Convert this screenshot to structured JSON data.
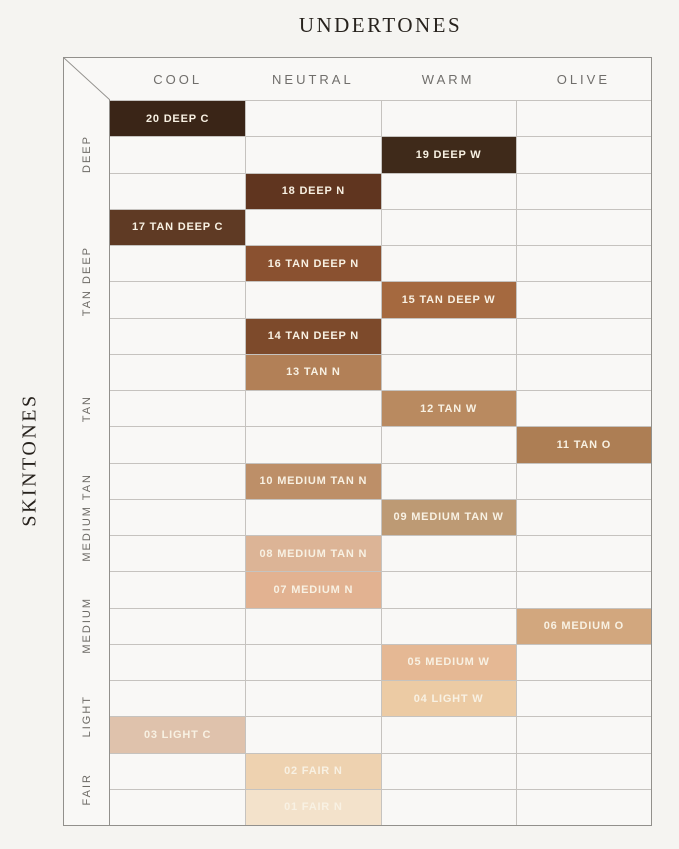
{
  "page": {
    "top_title": "UNDERTONES",
    "left_title": "SKINTONES"
  },
  "palette": {
    "page_bg": "#f5f4f1",
    "board_bg": "#f9f8f6",
    "outer_border": "#92908c",
    "grid_line": "#c6c3bf",
    "title_text": "#27221d",
    "header_text": "#706e6b",
    "group_text": "#6d6a65",
    "swatch_text": "#f8f1e3"
  },
  "chart_data": {
    "type": "table",
    "title": "UNDERTONES",
    "row_axis_label": "SKINTONES",
    "columns": [
      "COOL",
      "NEUTRAL",
      "WARM",
      "OLIVE"
    ],
    "row_groups": [
      {
        "label": "DEEP",
        "row_span": 3
      },
      {
        "label": "TAN DEEP",
        "row_span": 4
      },
      {
        "label": "TAN",
        "row_span": 3
      },
      {
        "label": "MEDIUM TAN",
        "row_span": 3
      },
      {
        "label": "MEDIUM",
        "row_span": 3
      },
      {
        "label": "LIGHT",
        "row_span": 2
      },
      {
        "label": "FAIR",
        "row_span": 2
      }
    ],
    "rows": [
      {
        "label": "20 DEEP C",
        "undertone": "COOL",
        "skintone_group": "DEEP",
        "color": "#3a2517"
      },
      {
        "label": "19 DEEP W",
        "undertone": "WARM",
        "skintone_group": "DEEP",
        "color": "#3f2a1a"
      },
      {
        "label": "18 DEEP N",
        "undertone": "NEUTRAL",
        "skintone_group": "DEEP",
        "color": "#60351f"
      },
      {
        "label": "17 TAN DEEP C",
        "undertone": "COOL",
        "skintone_group": "TAN DEEP",
        "color": "#5f3a24"
      },
      {
        "label": "16 TAN DEEP N",
        "undertone": "NEUTRAL",
        "skintone_group": "TAN DEEP",
        "color": "#8a5130"
      },
      {
        "label": "15 TAN DEEP W",
        "undertone": "WARM",
        "skintone_group": "TAN DEEP",
        "color": "#a5693f"
      },
      {
        "label": "14 TAN DEEP N",
        "undertone": "NEUTRAL",
        "skintone_group": "TAN DEEP",
        "color": "#7d4a2b"
      },
      {
        "label": "13 TAN N",
        "undertone": "NEUTRAL",
        "skintone_group": "TAN",
        "color": "#b28057"
      },
      {
        "label": "12 TAN W",
        "undertone": "WARM",
        "skintone_group": "TAN",
        "color": "#b98a60"
      },
      {
        "label": "11 TAN O",
        "undertone": "OLIVE",
        "skintone_group": "TAN",
        "color": "#ad7e54"
      },
      {
        "label": "10 MEDIUM TAN N",
        "undertone": "NEUTRAL",
        "skintone_group": "MEDIUM TAN",
        "color": "#bd8f68"
      },
      {
        "label": "09 MEDIUM TAN W",
        "undertone": "WARM",
        "skintone_group": "MEDIUM TAN",
        "color": "#bd9a74"
      },
      {
        "label": "08 MEDIUM TAN N",
        "undertone": "NEUTRAL",
        "skintone_group": "MEDIUM TAN",
        "color": "#dcb496"
      },
      {
        "label": "07 MEDIUM N",
        "undertone": "NEUTRAL",
        "skintone_group": "MEDIUM",
        "color": "#e2b291"
      },
      {
        "label": "06 MEDIUM O",
        "undertone": "OLIVE",
        "skintone_group": "MEDIUM",
        "color": "#d2a77e"
      },
      {
        "label": "05 MEDIUM W",
        "undertone": "WARM",
        "skintone_group": "MEDIUM",
        "color": "#e5b894"
      },
      {
        "label": "04 LIGHT W",
        "undertone": "WARM",
        "skintone_group": "LIGHT",
        "color": "#eccba4"
      },
      {
        "label": "03 LIGHT C",
        "undertone": "COOL",
        "skintone_group": "LIGHT",
        "color": "#dfc2ac"
      },
      {
        "label": "02 FAIR N",
        "undertone": "NEUTRAL",
        "skintone_group": "FAIR",
        "color": "#eed2b0"
      },
      {
        "label": "01 FAIR N",
        "undertone": "NEUTRAL",
        "skintone_group": "FAIR",
        "color": "#f3e2cb"
      }
    ]
  }
}
